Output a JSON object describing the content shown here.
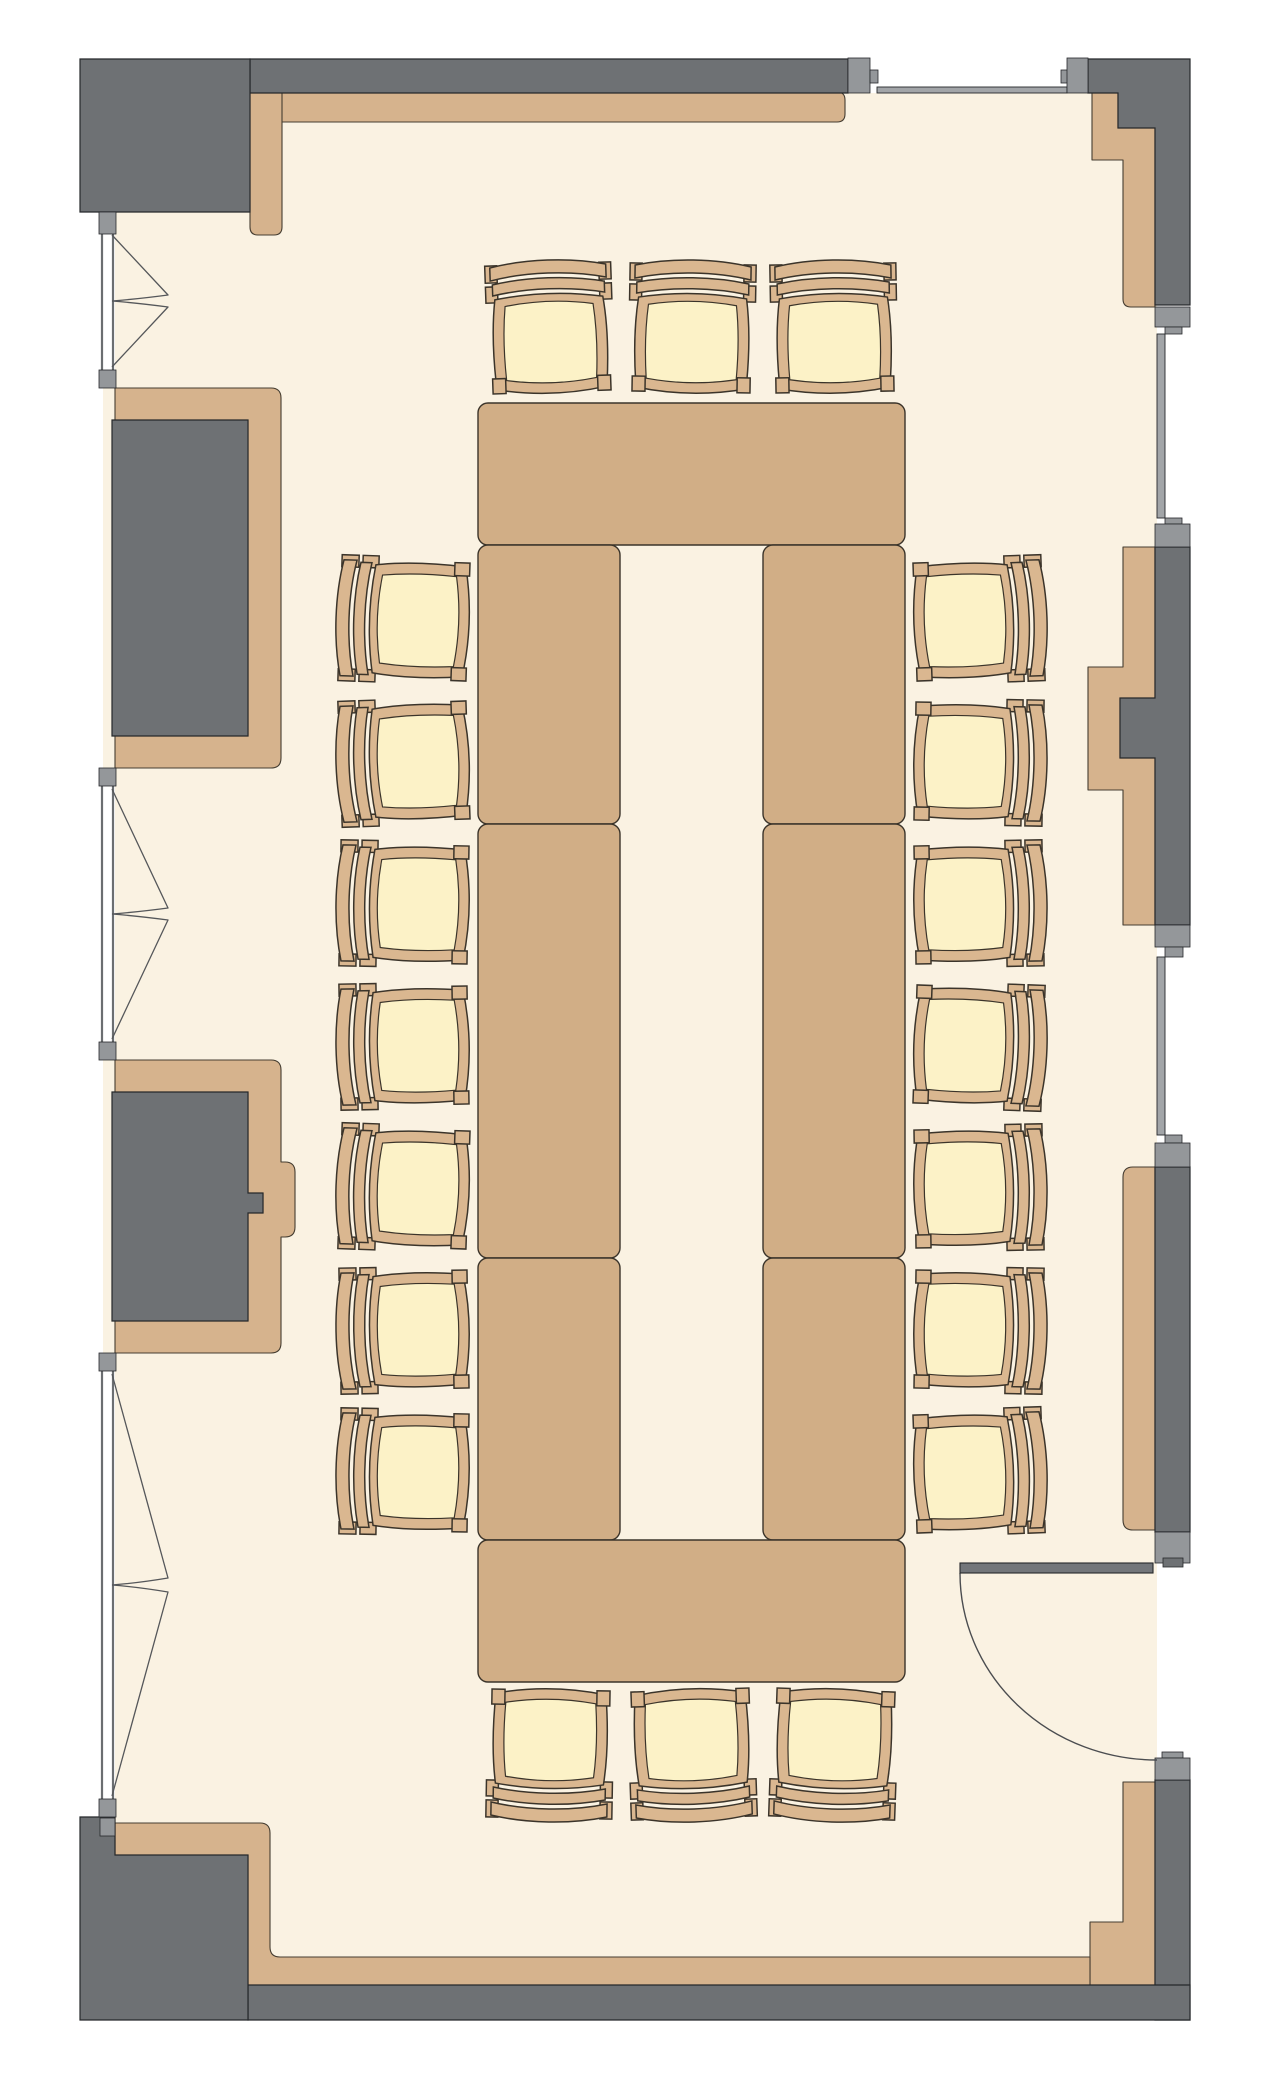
{
  "scene": {
    "type": "floor-plan",
    "room": "conference-room",
    "width": 1276,
    "height": 2100
  },
  "colors": {
    "outside": "#ffffff",
    "floor": "#faf2e2",
    "wall_dark": "#6e7174",
    "wall_jamb": "#94979a",
    "window_frame": "#a2a5a8",
    "window_line": "#6b6e71",
    "finish_tan": "#d6b38d",
    "table": "#d1ae86",
    "chair_wood": "#dab790",
    "chair_cushion": "#fcf2c7",
    "outline_wall": "#26282b",
    "outline_finish": "#453d31",
    "outline_wood": "#3b342a",
    "door_leaf": "#73767a",
    "swing_line": "#4b4d50",
    "casement_line": "#55575a"
  },
  "floor": {
    "x": 103,
    "y": 93,
    "w": 1054,
    "h": 1892
  },
  "walls_dark": [
    {
      "name": "wall-top-band",
      "d": "M250,59 H848 V93 H250 Z"
    },
    {
      "name": "wall-corner-top-left",
      "d": "M80,59 H250 V212 H80 Z"
    },
    {
      "name": "wall-corner-top-right",
      "d": "M1088,59 H1190 V305 H1155 V128 H1118 V93 H1088 Z"
    },
    {
      "name": "wall-pier-left-upper",
      "d": "M112,420 H248 V736 H112 Z"
    },
    {
      "name": "wall-pier-left-lower",
      "d": "M112,1092 H248 V1193 H263 V1213 H248 V1321 H112 Z"
    },
    {
      "name": "wall-pier-right-middle",
      "d": "M1155,547 H1190 V925 H1155 V758 H1120 V698 H1155 Z"
    },
    {
      "name": "wall-pier-right-door",
      "d": "M1155,1167 H1190 V1532 H1155 Z"
    },
    {
      "name": "wall-pier-right-bottom",
      "d": "M1155,1780 H1190 V2020 H1155 Z"
    },
    {
      "name": "wall-bottom-band",
      "d": "M248,1985 H1190 V2020 H248 Z"
    },
    {
      "name": "wall-corner-bottom-left",
      "d": "M80,1817 H115 V1855 H248 V2020 H80 Z"
    }
  ],
  "walls_finish": [
    {
      "name": "finish-top-band",
      "d": "M267,92 H837 Q845,92 845,100 V114 Q845,122 837,122 H267 Z"
    },
    {
      "name": "finish-top-left-vertical",
      "d": "M250,92 H282 V227 Q282,235 274,235 H258 Q250,235 250,227 Z"
    },
    {
      "name": "finish-top-right-corner",
      "d": "M1092,93 H1118 V128 H1155 V307 H1131 Q1123,307 1123,299 V160 H1092 Z"
    },
    {
      "name": "finish-pier-left-upper",
      "d": "M115,388 H271 Q281,388 281,398 V758 Q281,768 271,768 H115 V736 H248 V420 H115 Z"
    },
    {
      "name": "finish-pier-left-lower",
      "d": "M115,1060 H271 Q281,1060 281,1070 V1162 H285 Q295,1162 295,1172 V1227 Q295,1237 285,1237 H281 V1343 Q281,1353 271,1353 H115 V1321 H248 V1213 H263 V1193 H248 V1092 H115 Z"
    },
    {
      "name": "finish-pier-right-middle",
      "d": "M1123,547 H1155 V698 H1120 V758 H1155 V925 H1123 V790 H1088 V667 H1123 Z"
    },
    {
      "name": "finish-pier-right-door",
      "d": "M1133,1167 H1155 V1530 H1133 Q1123,1530 1123,1520 V1177 Q1123,1167 1133,1167 Z"
    },
    {
      "name": "finish-pier-right-bottom",
      "d": "M1123,1782 H1155 V1985 H1090 V1922 H1123 Z"
    },
    {
      "name": "finish-bottom-band",
      "d": "M115,1823 H260 Q270,1823 270,1833 V1947 Q270,1957 280,1957 H1090 V1985 H248 V1855 H115 Z"
    }
  ],
  "jambs": [
    {
      "x": 848,
      "y": 58,
      "w": 22,
      "h": 35
    },
    {
      "x": 870,
      "y": 70,
      "w": 8,
      "h": 13
    },
    {
      "x": 1061,
      "y": 70,
      "w": 7,
      "h": 13
    },
    {
      "x": 1067,
      "y": 58,
      "w": 21,
      "h": 35
    },
    {
      "x": 99,
      "y": 212,
      "w": 17,
      "h": 22
    },
    {
      "x": 99,
      "y": 370,
      "w": 17,
      "h": 18
    },
    {
      "x": 99,
      "y": 768,
      "w": 17,
      "h": 18
    },
    {
      "x": 99,
      "y": 1042,
      "w": 17,
      "h": 18
    },
    {
      "x": 99,
      "y": 1353,
      "w": 17,
      "h": 18
    },
    {
      "x": 99,
      "y": 1799,
      "w": 17,
      "h": 18
    },
    {
      "x": 100,
      "y": 1818,
      "w": 15,
      "h": 18
    },
    {
      "x": 1155,
      "y": 307,
      "w": 35,
      "h": 20
    },
    {
      "x": 1165,
      "y": 327,
      "w": 17,
      "h": 7
    },
    {
      "x": 1165,
      "y": 518,
      "w": 17,
      "h": 6
    },
    {
      "x": 1155,
      "y": 524,
      "w": 35,
      "h": 23
    },
    {
      "x": 1155,
      "y": 925,
      "w": 35,
      "h": 22
    },
    {
      "x": 1165,
      "y": 947,
      "w": 18,
      "h": 10
    },
    {
      "x": 1165,
      "y": 1135,
      "w": 17,
      "h": 8
    },
    {
      "x": 1155,
      "y": 1143,
      "w": 35,
      "h": 24
    },
    {
      "x": 1155,
      "y": 1532,
      "w": 35,
      "h": 31
    },
    {
      "x": 1163,
      "y": 1558,
      "w": 20,
      "h": 9,
      "dark": true
    },
    {
      "x": 1162,
      "y": 1752,
      "w": 21,
      "h": 6
    },
    {
      "x": 1155,
      "y": 1758,
      "w": 35,
      "h": 22
    }
  ],
  "windows": {
    "left_bays": [
      {
        "x": 100,
        "y": 232,
        "w": 15,
        "h": 138
      },
      {
        "x": 100,
        "y": 786,
        "w": 15,
        "h": 256
      },
      {
        "x": 100,
        "y": 1371,
        "w": 15,
        "h": 428
      }
    ],
    "right_strips": [
      {
        "x": 1157,
        "y": 334,
        "w": 8,
        "h": 184
      },
      {
        "x": 1157,
        "y": 957,
        "w": 8,
        "h": 178
      }
    ],
    "top_bar": {
      "x": 877,
      "y": 87,
      "w": 190,
      "h": 6
    },
    "casement_lines": [
      "M112,235 L168,295 Q138,299 112,301",
      "M112,367 L168,307 Q138,303 112,301",
      "M112,789 L168,908 Q138,912 112,914",
      "M112,1039 L168,920 Q138,916 112,914",
      "M112,1374 L168,1578 Q138,1583 112,1585",
      "M112,1796 L168,1592 Q138,1587 112,1585"
    ]
  },
  "door": {
    "leaf": {
      "x": 960,
      "y": 1563,
      "w": 193,
      "h": 10
    },
    "swing": "M960,1573 A197,187 0 0 0 1157,1760"
  },
  "tables": [
    {
      "name": "table-north",
      "x": 478,
      "y": 403,
      "w": 427,
      "h": 142
    },
    {
      "name": "table-west-1",
      "x": 478,
      "y": 545,
      "w": 142,
      "h": 279
    },
    {
      "name": "table-west-2",
      "x": 478,
      "y": 824,
      "w": 142,
      "h": 434
    },
    {
      "name": "table-west-3",
      "x": 478,
      "y": 1258,
      "w": 142,
      "h": 282
    },
    {
      "name": "table-east-1",
      "x": 763,
      "y": 545,
      "w": 142,
      "h": 279
    },
    {
      "name": "table-east-2",
      "x": 763,
      "y": 824,
      "w": 142,
      "h": 434
    },
    {
      "name": "table-east-3",
      "x": 763,
      "y": 1258,
      "w": 142,
      "h": 282
    },
    {
      "name": "table-south",
      "x": 478,
      "y": 1540,
      "w": 427,
      "h": 142
    }
  ],
  "chairs": [
    {
      "x": 550,
      "y": 332,
      "rot": 0,
      "tilt": -2
    },
    {
      "x": 692,
      "y": 332,
      "rot": 0,
      "tilt": 1
    },
    {
      "x": 834,
      "y": 332,
      "rot": 0,
      "tilt": -1
    },
    {
      "x": 408,
      "y": 620,
      "rot": -90,
      "tilt": 2
    },
    {
      "x": 408,
      "y": 762,
      "rot": -90,
      "tilt": -2
    },
    {
      "x": 408,
      "y": 904,
      "rot": -90,
      "tilt": 1
    },
    {
      "x": 408,
      "y": 1046,
      "rot": -90,
      "tilt": -1
    },
    {
      "x": 408,
      "y": 1188,
      "rot": -90,
      "tilt": 2
    },
    {
      "x": 408,
      "y": 1330,
      "rot": -90,
      "tilt": -1
    },
    {
      "x": 408,
      "y": 1472,
      "rot": -90,
      "tilt": 1
    },
    {
      "x": 975,
      "y": 620,
      "rot": 90,
      "tilt": -2
    },
    {
      "x": 975,
      "y": 762,
      "rot": 90,
      "tilt": 1
    },
    {
      "x": 975,
      "y": 904,
      "rot": 90,
      "tilt": -1
    },
    {
      "x": 975,
      "y": 1046,
      "rot": 90,
      "tilt": 2
    },
    {
      "x": 975,
      "y": 1188,
      "rot": 90,
      "tilt": -1
    },
    {
      "x": 975,
      "y": 1330,
      "rot": 90,
      "tilt": 1
    },
    {
      "x": 975,
      "y": 1472,
      "rot": 90,
      "tilt": -2
    },
    {
      "x": 550,
      "y": 1750,
      "rot": 180,
      "tilt": 1
    },
    {
      "x": 692,
      "y": 1750,
      "rot": 180,
      "tilt": -2
    },
    {
      "x": 834,
      "y": 1750,
      "rot": 180,
      "tilt": 2
    }
  ]
}
